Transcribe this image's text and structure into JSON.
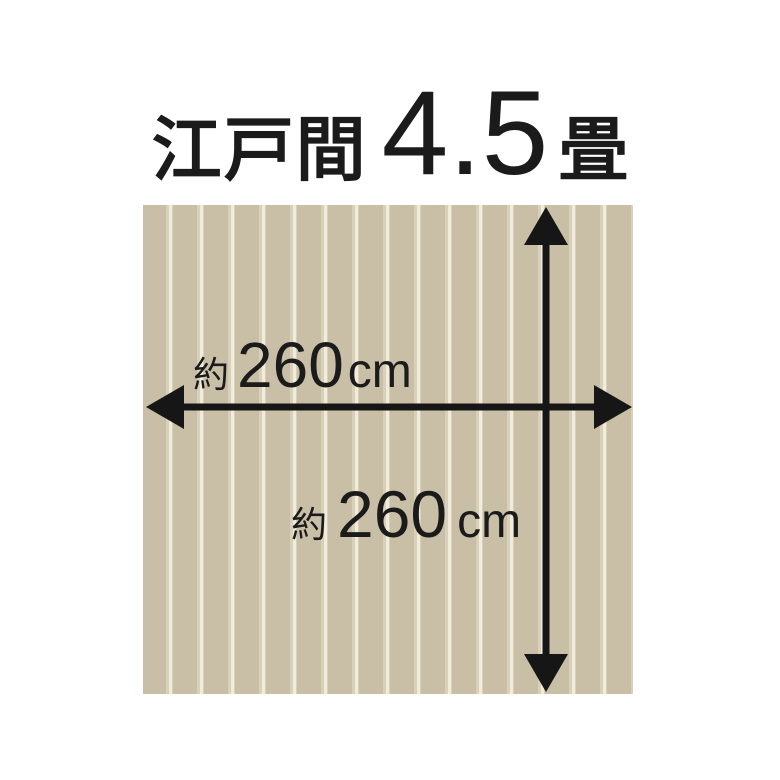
{
  "title": {
    "region": "江戸間",
    "size": "4.5",
    "unit": "畳"
  },
  "dimensions": {
    "width": {
      "prefix": "約",
      "value": "260",
      "unit": "cm"
    },
    "height": {
      "prefix": "約",
      "value": "260",
      "unit": "cm"
    }
  },
  "colors": {
    "background": "#ffffff",
    "text": "#1b1b1b",
    "arrow": "#161616",
    "rug_base": "#c9bfa6",
    "rug_mid": "#d9d0ba",
    "rug_groove": "#f1ebdb"
  }
}
